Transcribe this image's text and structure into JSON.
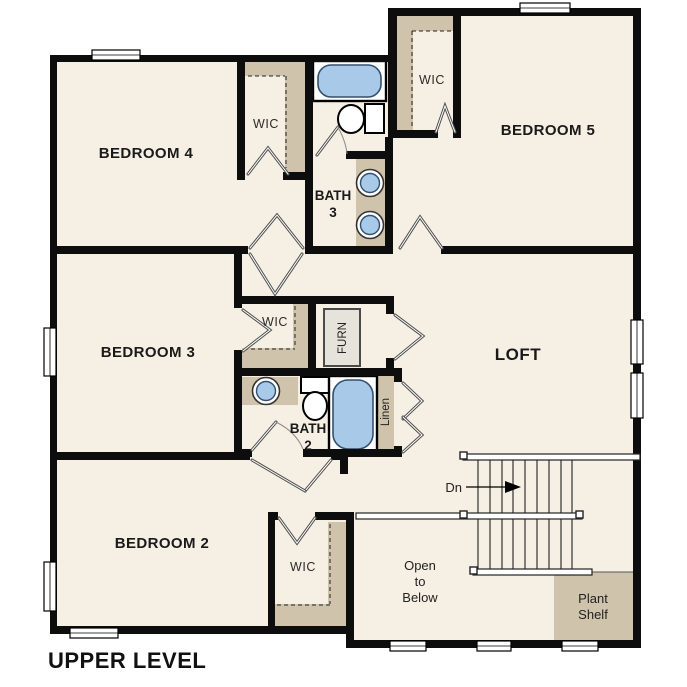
{
  "plan_title": "UPPER LEVEL",
  "rooms": {
    "bedroom4": "BEDROOM 4",
    "bedroom5": "BEDROOM 5",
    "bedroom3": "BEDROOM 3",
    "bedroom2": "BEDROOM 2",
    "loft": "LOFT",
    "bath3": {
      "l1": "BATH",
      "l2": "3"
    },
    "bath2": {
      "l1": "BATH",
      "l2": "2"
    }
  },
  "closets": {
    "wic_bedroom4": "WIC",
    "wic_bedroom5": "WIC",
    "wic_bedroom3": "WIC",
    "wic_bedroom2": "WIC",
    "linen": "Linen",
    "furnace": "FURN"
  },
  "stairs": {
    "direction_label": "Dn"
  },
  "annotations": {
    "open_to_below": {
      "l1": "Open",
      "l2": "to",
      "l3": "Below"
    },
    "plant_shelf": {
      "l1": "Plant",
      "l2": "Shelf"
    }
  },
  "colors": {
    "floor": "#f6efe3",
    "closet_shelf": "#cfc3ac",
    "fixture_blue": "#a9c9e9",
    "wall": "#0d0d0d"
  }
}
